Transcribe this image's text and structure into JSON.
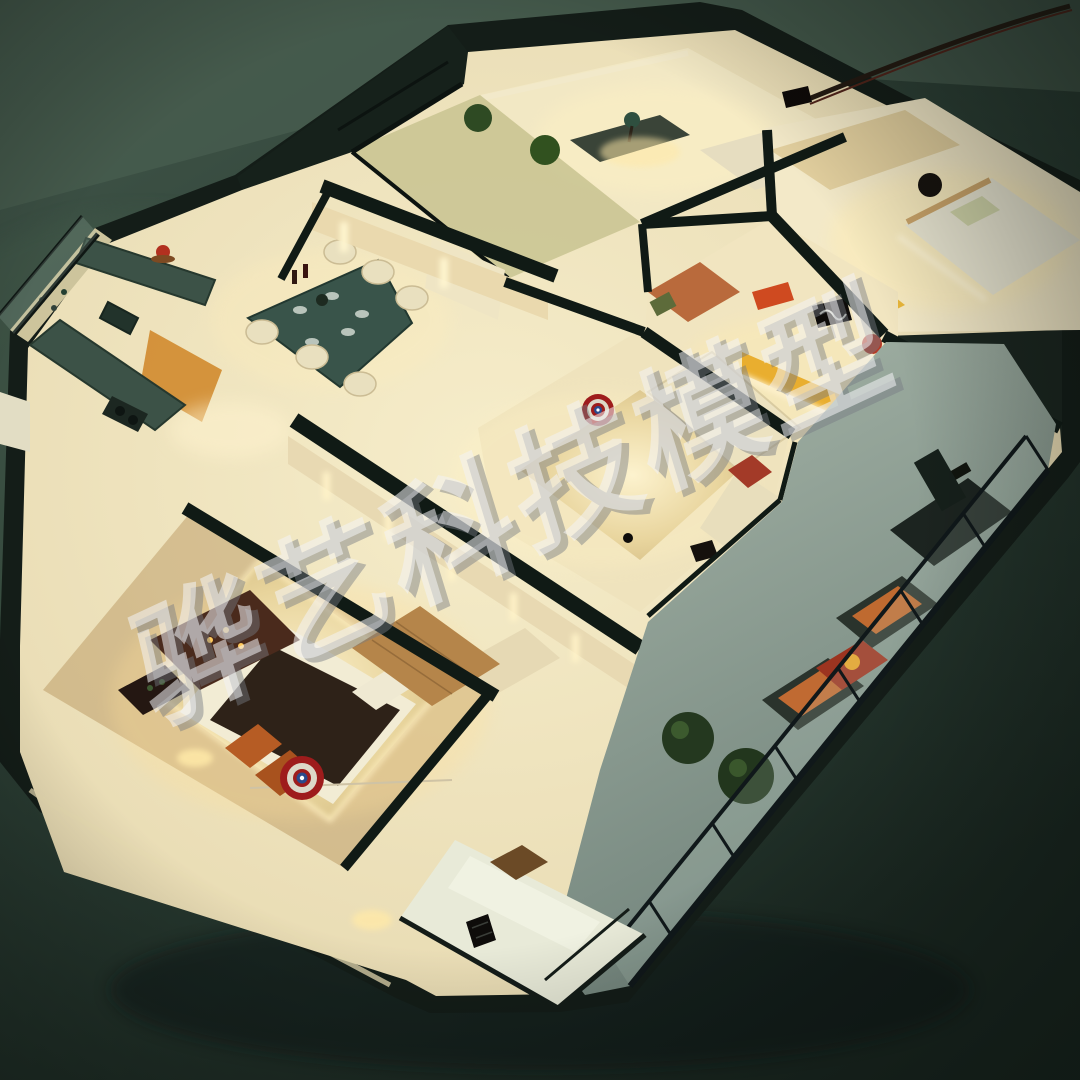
{
  "image": {
    "type": "photograph",
    "subject": "Illuminated miniature apartment scale model (dollhouse cutaway) viewed from above on a dark green table",
    "style": "isometric cutaway model with warm interior LED lighting"
  },
  "watermark": {
    "text": "骅艺科技模型",
    "color": "#f3f3f5",
    "shadow_color": "#767b83",
    "opacity": 0.55,
    "angle_deg": -25
  },
  "palette": {
    "background_top": "#465c4e",
    "background": "#2c3f35",
    "background_dark": "#1c2a23",
    "wall_top": "#141d18",
    "interior_warm": "#e9dcb4",
    "glow_warm": "#ffe9a8",
    "led_strip": "#fff4cc",
    "wood_floor": "#b5854a",
    "gold_rug": "#e8d49c",
    "counter_green": "#3c5247",
    "dining_table_green": "#39544a",
    "accent_orange": "#bf6a30",
    "shield_red": "#9e1c1c",
    "shield_blue": "#2b4a8c",
    "plant_green": "#2e4a23",
    "balcony_floor": "#93a498",
    "cable_brown": "#241a12"
  },
  "rooms": [
    {
      "name": "study",
      "objects": [
        "desk",
        "green table lamp",
        "cream sofa",
        "glass balustrade",
        "potted plants"
      ]
    },
    {
      "name": "bedroom top right",
      "objects": [
        "double bed",
        "green pillows",
        "wardrobe",
        "yellow desk",
        "black wall speaker"
      ]
    },
    {
      "name": "kids room",
      "objects": [
        "yellow shelf desk",
        "dark picture frame",
        "red storage box",
        "red ball",
        "led strip",
        "orange niche"
      ]
    },
    {
      "name": "living room",
      "objects": [
        "cream corner sofa",
        "red cushion",
        "gold rug",
        "captain america shield beanbag",
        "black remote"
      ]
    },
    {
      "name": "dining area",
      "objects": [
        "green marble dining table",
        "six cream chairs",
        "wine bottles",
        "place settings",
        "lit wall slits"
      ]
    },
    {
      "name": "kitchen",
      "objects": [
        "L-shaped green counter",
        "sink",
        "gas hob",
        "under-cabinet orange lighting",
        "red teapot",
        "balcony railing"
      ]
    },
    {
      "name": "master bedroom",
      "objects": [
        "platform bed",
        "dark duvet",
        "orange pillows",
        "captain america shield pillow",
        "gold sequin rug",
        "heart mirror",
        "fireplace dresser with candles",
        "wine rack",
        "wardrobe",
        "herringbone wood floor"
      ]
    },
    {
      "name": "long balcony",
      "objects": [
        "treadmill",
        "two lounge chairs with orange cushions",
        "red side table",
        "two topiary balls",
        "black glass railing"
      ]
    },
    {
      "name": "small balcony",
      "objects": [
        "white bench sofa",
        "brown cushion",
        "tv remote",
        "black railing"
      ]
    }
  ],
  "environment": {
    "surface": "dark green felt table",
    "power_cable": "enters from top right corner",
    "lighting": "warm interior LEDs, dark ambient room"
  }
}
